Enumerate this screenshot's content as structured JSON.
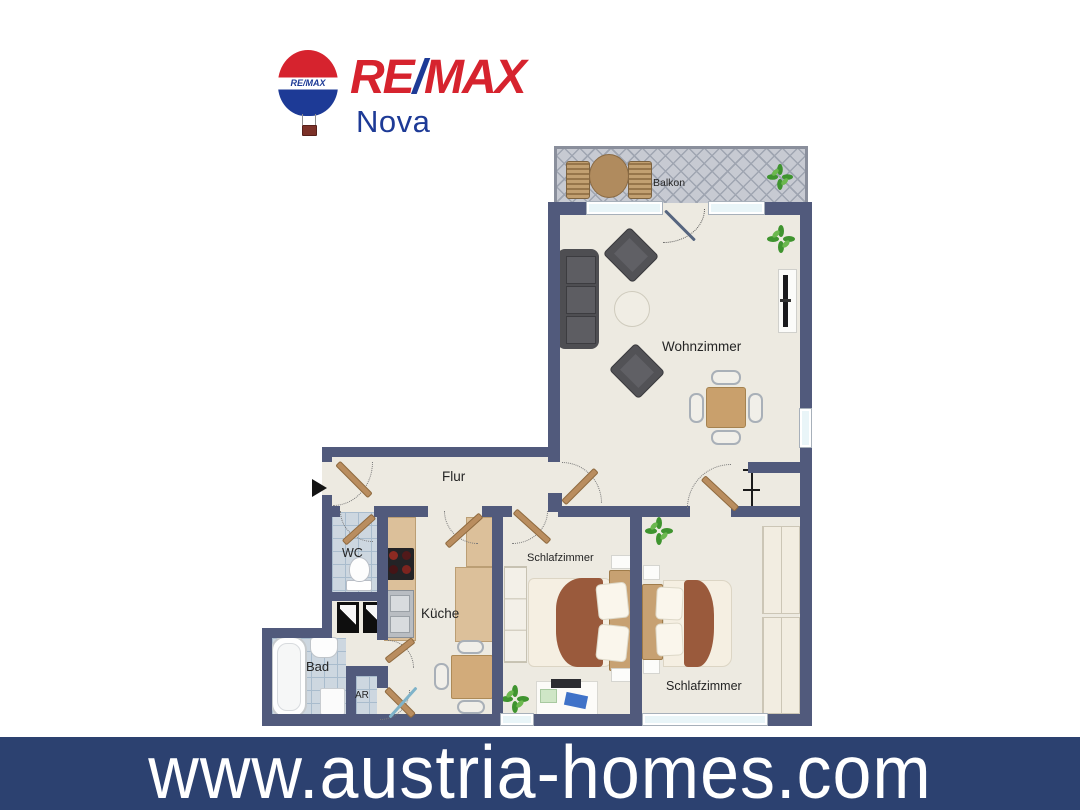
{
  "logo": {
    "re": "RE",
    "slash": "/",
    "max": "MAX",
    "sub_brand": "Nova",
    "balloon_band_text": "RE/MAX",
    "red": "#d6232e",
    "blue": "#1d3a96"
  },
  "floorplan": {
    "rooms": [
      {
        "label": "Balkon"
      },
      {
        "label": "Wohnzimmer"
      },
      {
        "label": "Flur"
      },
      {
        "label": "WC"
      },
      {
        "label": "Küche"
      },
      {
        "label": "Bad"
      },
      {
        "label": "AR"
      },
      {
        "label": "Schlafzimmer"
      },
      {
        "label": "Schlafzimmer"
      }
    ],
    "colors": {
      "wall": "#515a7c",
      "floor": "#edeae1",
      "tile": "#cdd7e0",
      "balcony_floor": "#c7cad2",
      "door_wood": "#b98d5f",
      "plant_green": "#3f942f",
      "blanket_brown": "#9a5a3c"
    }
  },
  "banner": {
    "url_text": "www.austria-homes.com",
    "background": "#2c4170",
    "text_color": "#ffffff"
  }
}
